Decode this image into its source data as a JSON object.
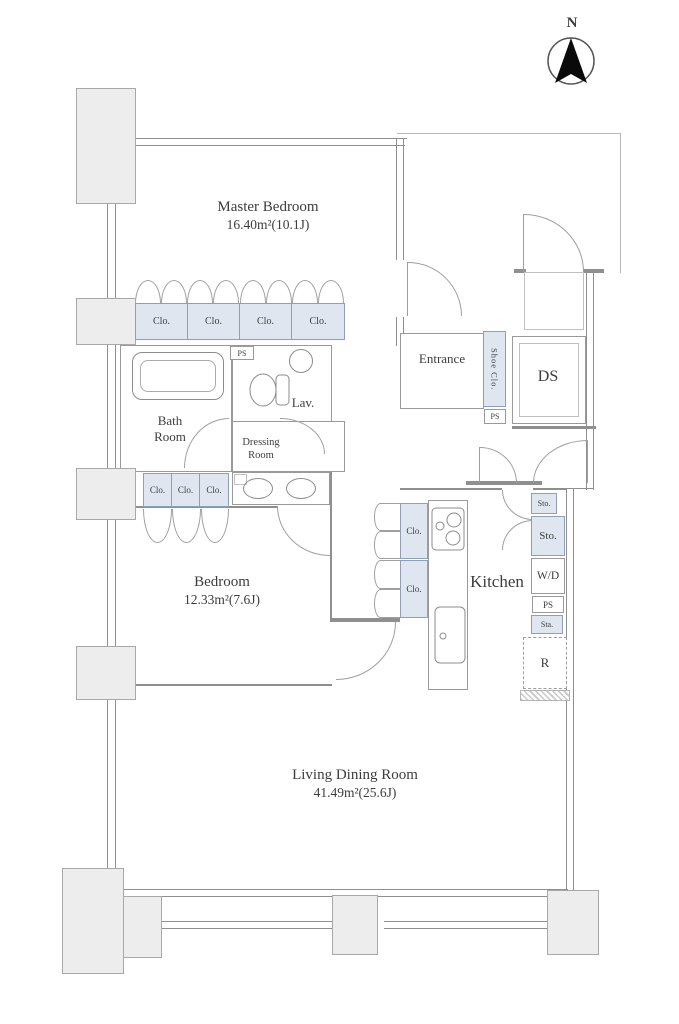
{
  "compass": {
    "north_label": "N"
  },
  "rooms": {
    "master_bedroom": {
      "name": "Master Bedroom",
      "area": "16.40m²(10.1J)"
    },
    "bedroom": {
      "name": "Bedroom",
      "area": "12.33m²(7.6J)"
    },
    "living_dining_room": {
      "name": "Living Dining Room",
      "area": "41.49m²(25.6J)"
    },
    "bath_room": {
      "line1": "Bath",
      "line2": "Room"
    },
    "lavatory": {
      "name": "Lav."
    },
    "dressing_room": {
      "line1": "Dressing",
      "line2": "Room"
    },
    "entrance": {
      "name": "Entrance"
    },
    "duct_space": {
      "name": "DS"
    },
    "kitchen": {
      "name": "Kitchen"
    }
  },
  "closets": {
    "master": [
      "Clo.",
      "Clo.",
      "Clo.",
      "Clo."
    ],
    "hall": [
      "Clo.",
      "Clo.",
      "Clo."
    ],
    "kitchen_side": [
      "Clo.",
      "Clo."
    ],
    "shoe": "Shoe Clo."
  },
  "utilities": {
    "ps_bath": "PS",
    "ps_entrance": "PS",
    "storage_small": "Sto.",
    "storage": "Sto.",
    "washer_dryer": "W/D",
    "ps_kitchen": "PS",
    "station": "Sta.",
    "refrigerator": "R"
  },
  "colors": {
    "closet_fill": "#dfe6f0",
    "pillar_fill": "#ededed",
    "wall_line": "#8f8f8f"
  }
}
